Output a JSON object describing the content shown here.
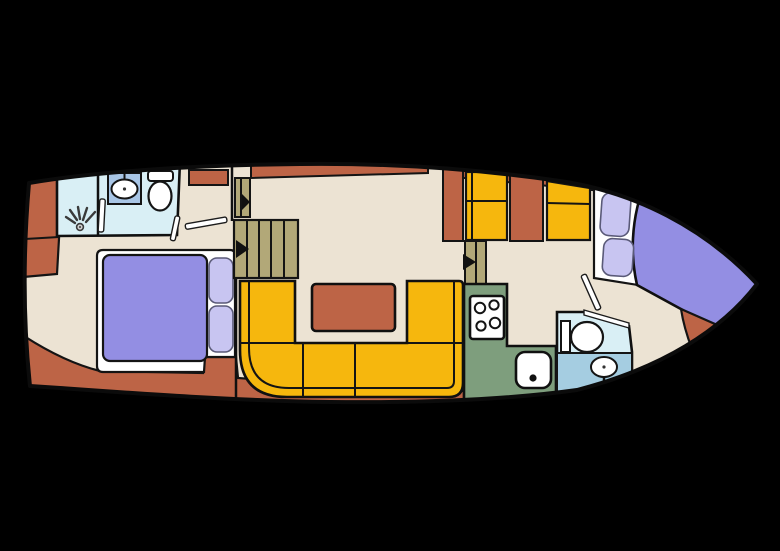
{
  "title": "Motor yacht interior deck floor plan",
  "colors": {
    "background": "#000000",
    "hull_floor": "#ece3d3",
    "outline": "#111111",
    "terracotta": "#bd6446",
    "sofa_yellow": "#f6b70d",
    "stair_khaki": "#b2a878",
    "galley_green": "#7e9e7d",
    "bath_cyan": "#d9eff5",
    "bath_blue": "#a5cde1",
    "sink_panel_blue": "#a9c6e6",
    "bed_lavender": "#938ee3",
    "pillow_lavender": "#c8c5f1",
    "fixture_white": "#ffffff",
    "arrow_black": "#111111"
  },
  "plan": {
    "vessel": "motor-yacht-deck-plan",
    "bow_side": "left",
    "stern_side": "right",
    "rooms": [
      {
        "name": "fore-bathroom",
        "features": [
          "shower",
          "washbasin",
          "toilet"
        ]
      },
      {
        "name": "fore-cabin",
        "features": [
          "double-bed",
          "two-pillows",
          "wardrobe"
        ]
      },
      {
        "name": "salon",
        "features": [
          "u-shaped-sofa",
          "table",
          "companionway-stairs"
        ]
      },
      {
        "name": "galley",
        "features": [
          "stove-4-burners",
          "sink",
          "cabinets"
        ]
      },
      {
        "name": "aft-bathroom",
        "features": [
          "toilet",
          "washbasin"
        ]
      },
      {
        "name": "aft-cabin",
        "features": [
          "double-bed",
          "two-pillows"
        ]
      }
    ],
    "stairs": [
      {
        "name": "fore-steps-upper",
        "direction_arrow": "right"
      },
      {
        "name": "fore-steps-main",
        "direction_arrow": "right"
      },
      {
        "name": "aft-steps",
        "direction_arrow": "right"
      }
    ]
  }
}
